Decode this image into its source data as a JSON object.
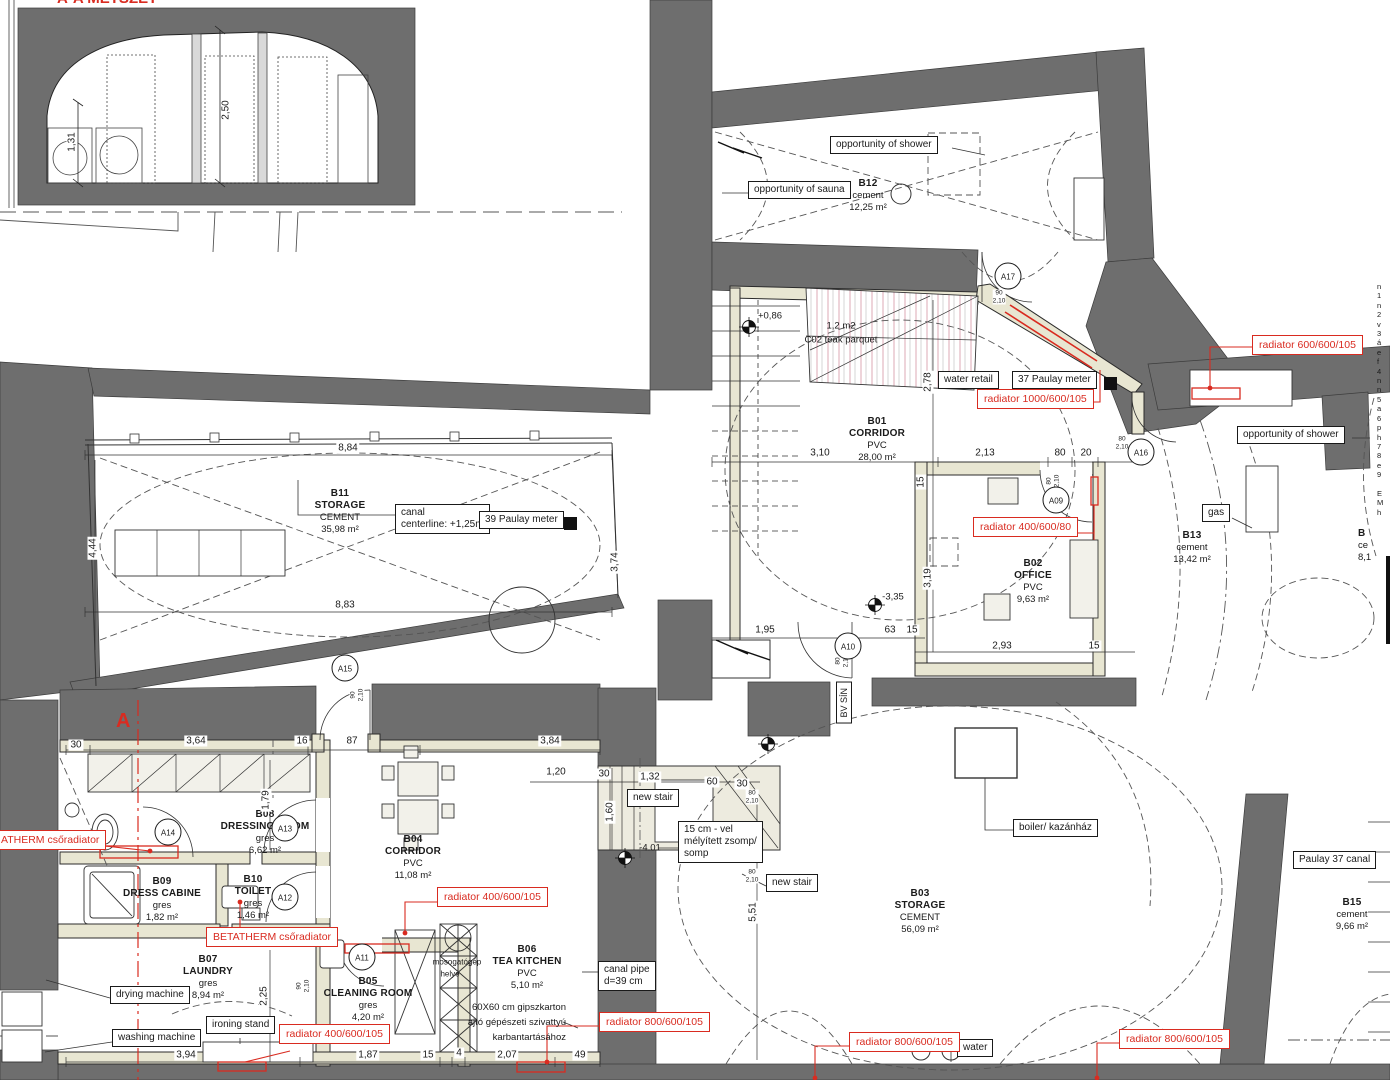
{
  "title": "A-A METSZET",
  "section_marker": "A",
  "rooms": {
    "b11": {
      "id": "B11",
      "name": "STORAGE",
      "floor": "CEMENT",
      "area": "35,98 m²"
    },
    "b12": {
      "id": "B12",
      "name": "",
      "floor": "cement",
      "area": "12,25 m²"
    },
    "b01": {
      "id": "B01",
      "name": "CORRIDOR",
      "floor": "PVC",
      "area": "28,00 m²"
    },
    "b02": {
      "id": "B02",
      "name": "OFFICE",
      "floor": "PVC",
      "area": "9,63 m²"
    },
    "b13": {
      "id": "B13",
      "name": "",
      "floor": "cement",
      "area": "13,42 m²"
    },
    "b14": {
      "id": "B",
      "name": "",
      "floor": "ce",
      "area": "8,1"
    },
    "b08": {
      "id": "B08",
      "name": "DRESSING ROOM",
      "floor": "gres",
      "area": "6,62 m²"
    },
    "b09": {
      "id": "B09",
      "name": "DRESS CABINE",
      "floor": "gres",
      "area": "1,82 m²"
    },
    "b10": {
      "id": "B10",
      "name": "TOILET",
      "floor": "gres",
      "area": "1,46 m²"
    },
    "b07": {
      "id": "B07",
      "name": "LAUNDRY",
      "floor": "gres",
      "area": "8,94 m²"
    },
    "b05": {
      "id": "B05",
      "name": "CLEANING ROOM",
      "floor": "gres",
      "area": "4,20 m²"
    },
    "b04": {
      "id": "B04",
      "name": "CORRIDOR",
      "floor": "PVC",
      "area": "11,08 m²"
    },
    "b06": {
      "id": "B06",
      "name": "TEA KITCHEN",
      "floor": "PVC",
      "area": "5,10 m²"
    },
    "b03": {
      "id": "B03",
      "name": "STORAGE",
      "floor": "CEMENT",
      "area": "56,09 m²"
    },
    "b15": {
      "id": "B15",
      "name": "",
      "floor": "cement",
      "area": "9,66 m²"
    }
  },
  "annotations": {
    "shower": "opportunity of shower",
    "sauna": "opportunity of sauna",
    "water_retail": "water retail",
    "paulay37": "37 Paulay meter",
    "canal1": "canal",
    "canal2": "centerline: +1,25m",
    "paulay39": "39 Paulay meter",
    "gas": "gas",
    "bv_sin": "BV SÍN",
    "boiler": "boiler/ kazánház",
    "paulay_canal": "Paulay 37 canal",
    "new_stair": "new stair",
    "zsomp1": "15 cm - vel",
    "zsomp2": "mélyített zsomp/",
    "zsomp3": "somp",
    "canal_pipe1": "canal pipe",
    "canal_pipe2": "d=39 cm",
    "drying": "drying machine",
    "washing": "washing machine",
    "ironing": "ironing stand",
    "water": "water"
  },
  "radiators": {
    "r600": "radiator  600/600/105",
    "r1000": "radiator  1000/600/105",
    "r400_80": "radiator  400/600/80",
    "r400": "radiator  400/600/105",
    "r800": "radiator  800/600/105",
    "betatherm": "BETATHERM csőradiator",
    "atherm": "ATHERM csőradiator"
  },
  "levels": {
    "p1": "+0,86",
    "p2": "-3,35",
    "p3": "-4.01"
  },
  "notes": {
    "teak1": "1,2 m2",
    "teak2": "C02 teak parquet",
    "mosogato1": "mosogatógép",
    "mosogato2": "helye",
    "gipsz1": "60X60 cm gipszkarton",
    "gipsz2": "ajtó gépészeti szivattyú",
    "gipsz3": "karbantartásához"
  },
  "doors": {
    "a17": "A17",
    "a16": "A16",
    "a09": "A09",
    "a10": "A10",
    "a15": "A15",
    "a14": "A14",
    "a13": "A13",
    "a12": "A12",
    "a11": "A11"
  },
  "door_dims": [
    {
      "w": "90",
      "h": "2,10"
    },
    {
      "w": "80",
      "h": "2,10"
    },
    {
      "w": "80",
      "h": "2,10"
    },
    {
      "w": "80",
      "h": "2,10"
    },
    {
      "w": "80",
      "h": "2,10"
    },
    {
      "w": "90",
      "h": "2,10"
    },
    {
      "w": "90",
      "h": "2,10"
    },
    {
      "w": "80",
      "h": "2,10"
    }
  ],
  "dims": [
    "8,84",
    "8,83",
    "4,44",
    "3,74",
    "3,10",
    "2,13",
    "80",
    "20",
    "2,78",
    "3,19",
    "1,95",
    "63",
    "15",
    "2,93",
    "15",
    "15",
    "30",
    "3,64",
    "16",
    "87",
    "3,84",
    "1,79",
    "1,20",
    "30",
    "1,32",
    "60",
    "30",
    "1,60",
    "5,51",
    "2,25",
    "3,94",
    "1,87",
    "15",
    "4",
    "2,07",
    "49",
    "2,50",
    "1,31"
  ],
  "edge_notes": "n\n1\nn\n2\nv\n3\ná\ne\nf\n4\nn\nn\n5\na\n6\np\nh\n7\n8\ne\n9\n \nE\nM\nh",
  "colors": {
    "wall": "#6e6e6e",
    "red": "#d92b20",
    "beige": "#e8e6d2"
  }
}
